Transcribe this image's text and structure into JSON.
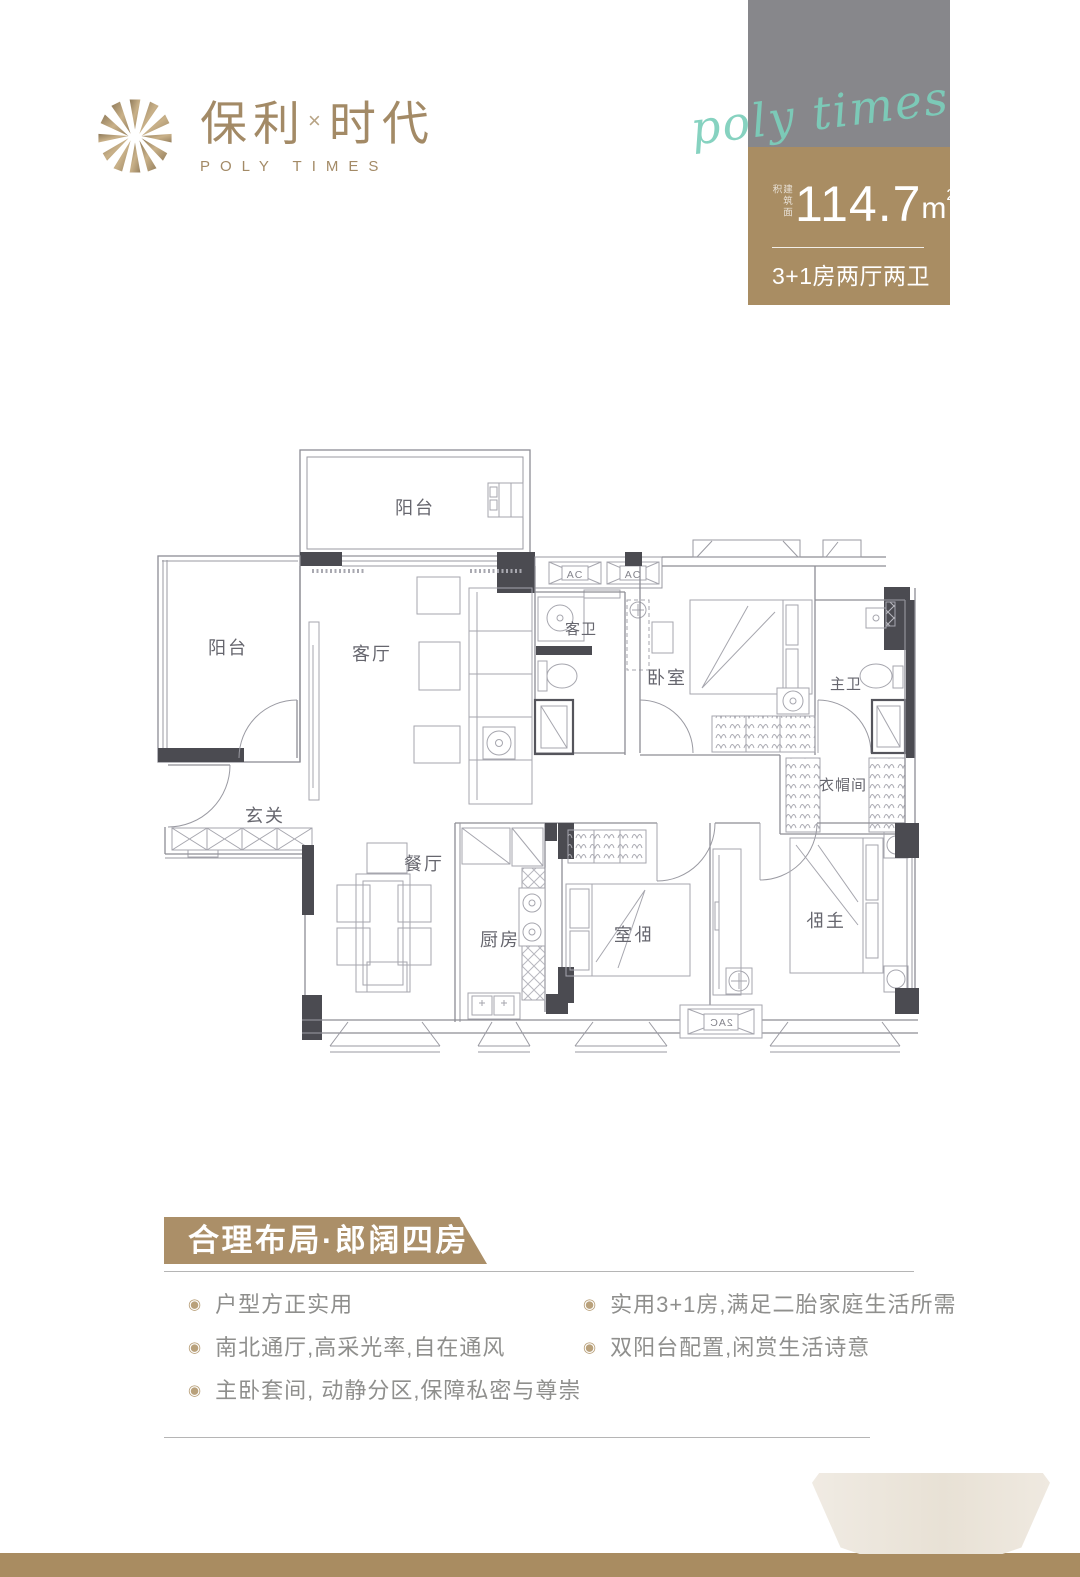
{
  "brand": {
    "zh_left": "保利",
    "sep": "×",
    "zh_right": "时代",
    "en": "POLY TIMES",
    "color": "#a38a66"
  },
  "unit_card": {
    "script": "poly times",
    "area_label": "建筑面积",
    "area_value": "114.7",
    "area_unit": "m",
    "area_sup": "2",
    "spec": "3+1房两厅两卫",
    "colors": {
      "gray": "#87878b",
      "gold": "#a98d63",
      "script_teal": "#7ccfbb"
    }
  },
  "floor_plan": {
    "labels": {
      "balcony_top": "阳台",
      "balcony_left": "阳台",
      "living": "客厅",
      "foyer": "玄关",
      "dining": "餐厅",
      "kitchen": "厨房",
      "guest_bath": "客卫",
      "bedroom_top": "卧室",
      "master_bath": "主卫",
      "closet": "衣帽间",
      "bedroom_bottom": "卧室",
      "master_bedroom": "主卧",
      "ac1": "AC",
      "ac2": "AC",
      "ac_bottom": "2AC"
    }
  },
  "section": {
    "title": "合理布局·郎阔四房",
    "bullet_glyph": "◉",
    "bullets_left": [
      "户型方正实用",
      "南北通厅,高采光率,自在通风",
      "主卧套间, 动静分区,保障私密与尊崇"
    ],
    "bullets_right": [
      "实用3+1房,满足二胎家庭生活所需",
      "双阳台配置,闲赏生活诗意"
    ],
    "banner_color": "#ab8f68",
    "band_color": "#a98c61"
  }
}
